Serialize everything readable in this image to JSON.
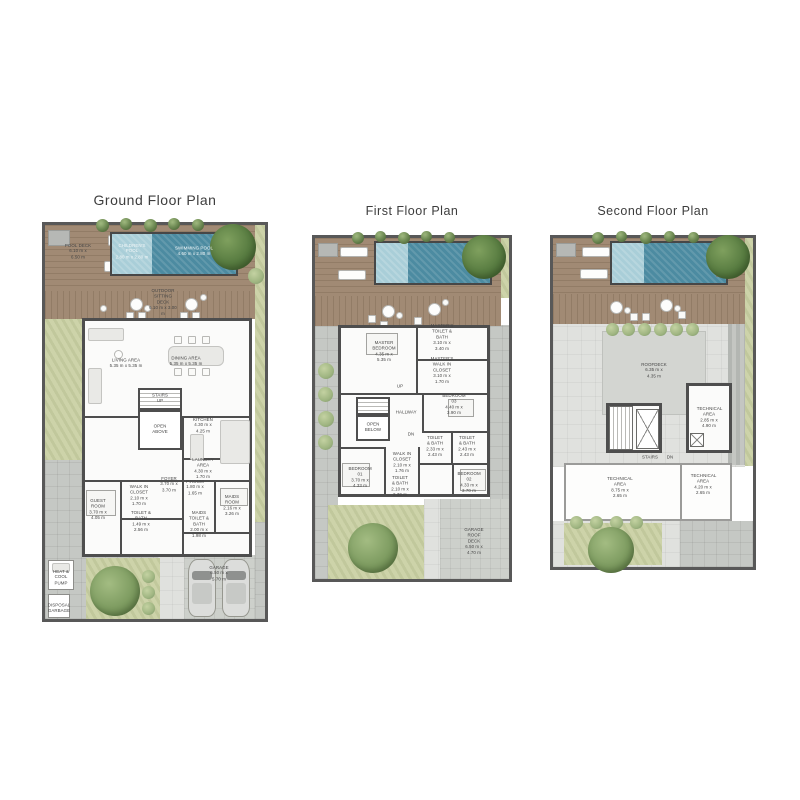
{
  "palette": {
    "pool_dark": "#4c8ba1",
    "pool_light": "#a9ced8",
    "deck_wood": "#a18a74",
    "lawn_green": "#cdd3a9",
    "tree_green": "#7e9c61",
    "wall_gray": "#4e4e4e",
    "paving_gray": "#c5c8c4",
    "title_gray": "#3d3d3d"
  },
  "plans": [
    {
      "title": "Ground Floor Plan",
      "labels": [
        {
          "name": "POOL DECK",
          "dims": "6.10 m x 6.50 m"
        },
        {
          "name": "CHILDREN'S POOL",
          "dims": "2.80 m x 2.80 m"
        },
        {
          "name": "SWIMMING POOL",
          "dims": "4.60 m x 2.80 m"
        },
        {
          "name": "OUTDOOR SITTING DECK",
          "dims": "6.10 m x 3.00 m"
        },
        {
          "name": "LIVING AREA",
          "dims": "5.35 m x 5.35 m"
        },
        {
          "name": "DINING AREA",
          "dims": "5.35 m x 5.35 m"
        },
        {
          "name": "STAIRS UP",
          "dims": ""
        },
        {
          "name": "OPEN ABOVE",
          "dims": ""
        },
        {
          "name": "KITCHEN",
          "dims": "4.30 m x 4.25 m"
        },
        {
          "name": "LAUNDRY AREA",
          "dims": "4.30 m x 1.70 m"
        },
        {
          "name": "FOYER",
          "dims": "3.70 m x 3.70 m"
        },
        {
          "name": "P.ROOM",
          "dims": "1.80 m x 1.65 m"
        },
        {
          "name": "WALK IN CLOSET",
          "dims": "2.10 m x 1.70 m"
        },
        {
          "name": "GUEST ROOM",
          "dims": "3.70 m x 4.05 m"
        },
        {
          "name": "TOILET & BATH",
          "dims": "1.49 m x 2.56 m"
        },
        {
          "name": "MAIDS ROOM",
          "dims": "2.16 m x 3.26 m"
        },
        {
          "name": "MAIDS TOILET & BATH",
          "dims": "2.00 m x 1.98 m"
        },
        {
          "name": "HEAT & COOL PUMP",
          "dims": ""
        },
        {
          "name": "DISPOSAL GARBAGE",
          "dims": ""
        },
        {
          "name": "GARAGE",
          "dims": "6.50 m x 5.70 m"
        }
      ]
    },
    {
      "title": "First Floor Plan",
      "labels": [
        {
          "name": "MASTER BEDROOM",
          "dims": "4.35 m x 5.35 m"
        },
        {
          "name": "MASTER'S TOILET & BATH",
          "dims": "3.10 m x 3.40 m"
        },
        {
          "name": "MASTER'S WALK IN CLOSET",
          "dims": "3.10 m x 1.70 m"
        },
        {
          "name": "BEDROOM 03",
          "dims": "4.40 m x 3.90 m"
        },
        {
          "name": "UP",
          "dims": ""
        },
        {
          "name": "OPEN BELOW",
          "dims": ""
        },
        {
          "name": "HALLWAY",
          "dims": ""
        },
        {
          "name": "DN",
          "dims": ""
        },
        {
          "name": "TOILET & BATH",
          "dims": "2.33 m x 2.43 m"
        },
        {
          "name": "TOILET & BATH",
          "dims": "2.43 m x 2.43 m"
        },
        {
          "name": "WALK IN CLOSET",
          "dims": "2.10 m x 1.76 m"
        },
        {
          "name": "TOILET & BATH",
          "dims": "2.10 m x 2.30 m"
        },
        {
          "name": "BEDROOM 01",
          "dims": "3.70 m x 4.33 m"
        },
        {
          "name": "BEDROOM 02",
          "dims": "4.33 m x 3.70 m"
        },
        {
          "name": "GARAGE ROOF DECK",
          "dims": "6.50 m x 4.70 m"
        }
      ]
    },
    {
      "title": "Second Floor Plan",
      "labels": [
        {
          "name": "ROOFDECK",
          "dims": "6.35 m x 4.35 m"
        },
        {
          "name": "TECHNICAL AREA",
          "dims": "2.85 m x 4.90 m"
        },
        {
          "name": "STAIRS",
          "dims": ""
        },
        {
          "name": "DN",
          "dims": ""
        },
        {
          "name": "TECHNICAL AREA",
          "dims": "8.75 m x 2.65 m"
        },
        {
          "name": "TECHNICAL AREA",
          "dims": "4.20 m x 2.65 m"
        }
      ]
    }
  ]
}
